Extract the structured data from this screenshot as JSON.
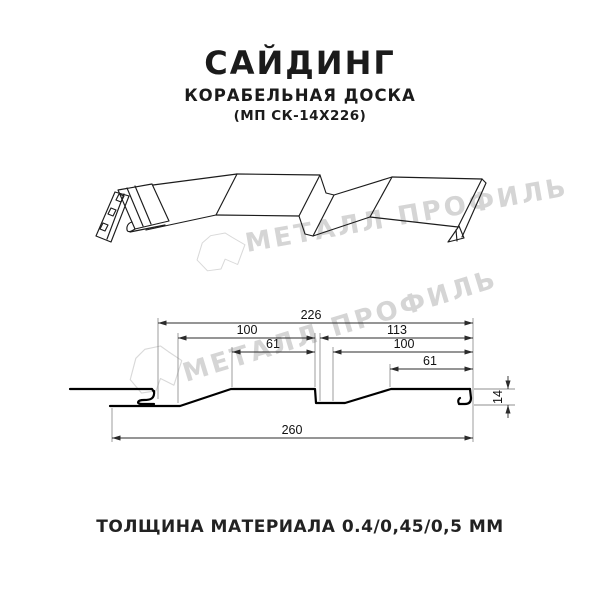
{
  "header": {
    "title": "САЙДИНГ",
    "subtitle": "КОРАБЕЛЬНАЯ ДОСКА",
    "model": "(МП СК-14Х226)"
  },
  "watermark": {
    "brand": "МЕТАЛЛ ПРОФИЛЬ",
    "color": "#d5d5d5"
  },
  "drawing": {
    "kind": "siding profile: 3D view and dimensioned cross-section",
    "dimensions_mm": {
      "overall_useful_width": "226",
      "board1_width": "100",
      "board2_span": "113",
      "board1_flat": "61",
      "board2_width": "100",
      "board2_flat": "61",
      "total_width": "260",
      "profile_height": "14"
    }
  },
  "footer": {
    "thickness": "ТОЛЩИНА МАТЕРИАЛА 0.4/0,45/0,5 ММ"
  }
}
